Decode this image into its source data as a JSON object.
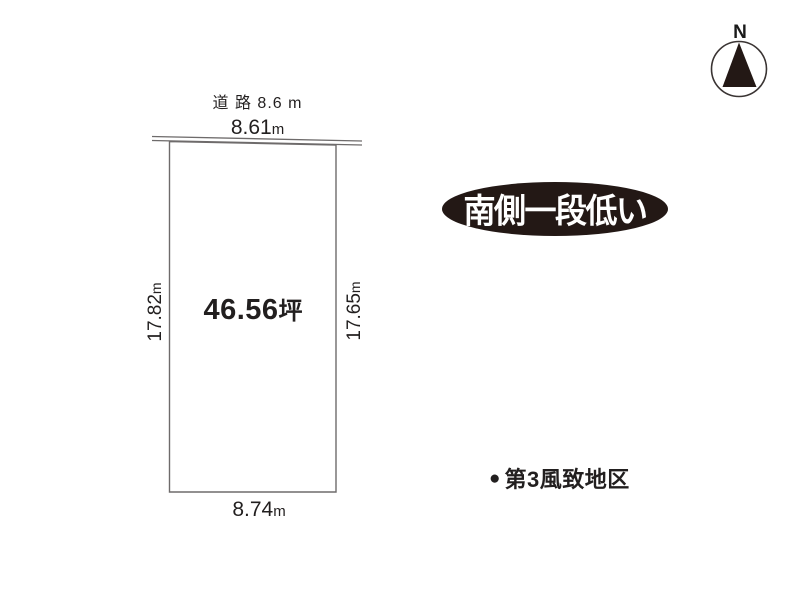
{
  "diagram": {
    "north_label": "N",
    "road_label": "道 路 8.6 m",
    "plot": {
      "area_value": "46.56",
      "area_unit": "坪",
      "top_width_value": "8.61",
      "top_width_unit": "m",
      "bottom_width_value": "8.74",
      "bottom_width_unit": "m",
      "left_depth_value": "17.82",
      "left_depth_unit": "m",
      "right_depth_value": "17.65",
      "right_depth_unit": "m"
    },
    "badge_text": "南側一段低い",
    "note_bullet": "●",
    "note_text": "第3風致地区",
    "colors": {
      "ink": "#221f1f",
      "line": "#6e6b6b",
      "badge_bg": "#231815",
      "badge_text": "#ffffff",
      "background": "#ffffff"
    }
  }
}
